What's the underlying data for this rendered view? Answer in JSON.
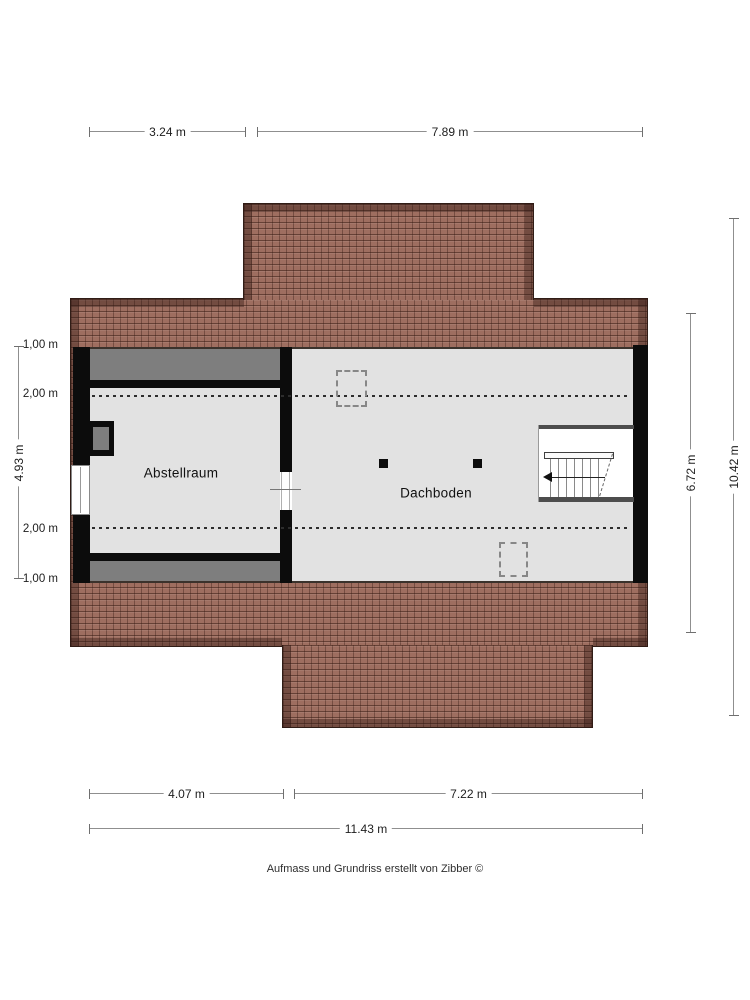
{
  "plan": {
    "title_type": "attic floor plan",
    "rooms": {
      "abstellraum": "Abstellraum",
      "dachboden": "Dachboden"
    },
    "dimensions": {
      "top": [
        "3.24 m",
        "7.89 m"
      ],
      "bottom": [
        "4.07 m",
        "7.22 m"
      ],
      "bottom_total": "11.43 m",
      "left_height_labels": [
        "1,00 m",
        "2,00 m",
        "2,00 m",
        "1,00 m"
      ],
      "left_overall": "4.93 m",
      "right_inner": "6.72 m",
      "right_overall": "10.42 m"
    },
    "footer_credit": "Aufmass und Grundriss erstellt von Zibber ©"
  },
  "colors": {
    "roof_tile": "#9E6E60",
    "roof_edge_band": "#5F3D31",
    "floor": "#E2E2E2",
    "low_headroom_gray": "#7E7E7E",
    "wall": "#0C0C0C",
    "dimension_line": "#8F8F8F",
    "background": "#FFFFFF"
  }
}
